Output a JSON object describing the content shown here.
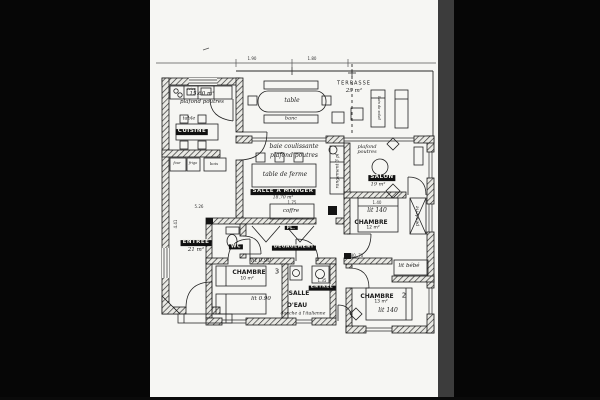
{
  "scan": {
    "page_bg": "#f6f6f3",
    "ink": "#1c1c1c",
    "surround": "#060606"
  },
  "dims": {
    "d190": "1.90",
    "d180": "1.80",
    "d526": "5.26",
    "d441": "4.41",
    "d175": "1.75",
    "d140": "1.40",
    "d135": "1.35",
    "d8070": "80  70"
  },
  "terrasse": {
    "name": "TERRASSE",
    "area": "29 m²",
    "table": "table",
    "banc": "banc",
    "lounger": "bain de soleil"
  },
  "cuisine": {
    "name": "CUISINE",
    "area": "15.60 m²",
    "note": "plafond poutres",
    "table": "table",
    "evier": "évier",
    "four": "four",
    "frigo": "frigo",
    "bois": "bois"
  },
  "sejour": {
    "name": "SALLE A MANGER",
    "area": "18.70 m²",
    "baie": "baie coulissante",
    "note": "plafond poutres",
    "table": "table de ferme",
    "coffre": "coffre"
  },
  "salon": {
    "name": "SALON",
    "area": "19 m²",
    "note": "plafond poutres",
    "rangement": "rangement 3 pl"
  },
  "chambre1": {
    "name": "CHAMBRE",
    "area": "12 m²",
    "lit": "lit 140",
    "penderie": "penderie",
    "bebe": "lit bébé"
  },
  "chambre2": {
    "name": "CHAMBRE",
    "num": "2",
    "area": "13 m²",
    "lit": "lit 140"
  },
  "chambre3": {
    "name": "CHAMBRE",
    "num": "3",
    "area": "10 m²",
    "lit1": "lit 0.90",
    "lit2": "lit 0.90"
  },
  "salle_eau": {
    "name1": "SALLE",
    "name2": "D'EAU",
    "note": "douche à l'italienne"
  },
  "wc": {
    "name": "WC"
  },
  "degagement": {
    "name": "DEGAGEMENT",
    "pl": "PL."
  },
  "entree": {
    "name": "ENTREE",
    "area": "21 m²"
  },
  "entree_arriere": {
    "name": "ENTREE"
  }
}
